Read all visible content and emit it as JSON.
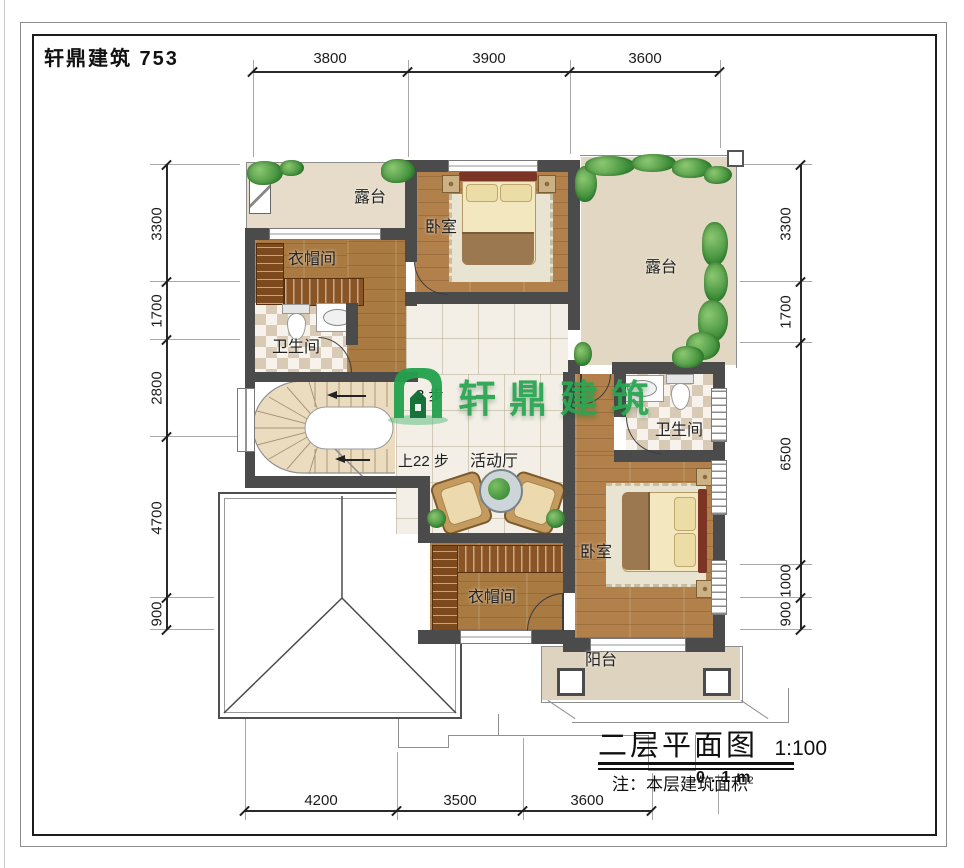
{
  "brand": {
    "title": "轩鼎建筑 753"
  },
  "watermark": {
    "text": "轩鼎建筑"
  },
  "titleblock": {
    "title": "二层平面图",
    "scale": "1:100",
    "note_label": "注：本层建筑面积",
    "note_overlay": "0.1m",
    "note_sup": "2"
  },
  "stairs": {
    "up": "上22 步",
    "mid": "3 步"
  },
  "dims": {
    "top": [
      "3800",
      "3900",
      "3600"
    ],
    "left": [
      "3300",
      "1700",
      "2800",
      "4700",
      "900"
    ],
    "right": [
      "3300",
      "1700",
      "6500",
      "1000",
      "900"
    ],
    "bottom": [
      "4200",
      "3500",
      "3600"
    ]
  },
  "rooms": {
    "terrace_tl": "露台",
    "bedroom_top": "卧室",
    "terrace_r": "露台",
    "cloak_l": "衣帽间",
    "bath_l": "卫生间",
    "hall": "活动厅",
    "bath_r": "卫生间",
    "bedroom_b": "卧室",
    "cloak_b": "衣帽间",
    "balcony": "阳台"
  }
}
